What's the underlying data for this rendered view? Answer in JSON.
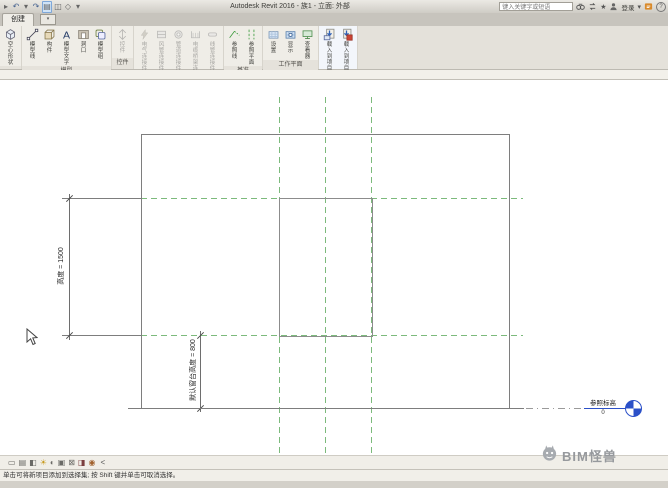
{
  "window": {
    "title": "Autodesk Revit 2016 - 族1 - 立面: 外部"
  },
  "qat": {
    "icons": [
      {
        "name": "modify-arrow-icon",
        "glyph": "▸",
        "gray": true
      },
      {
        "name": "undo-icon",
        "glyph": "↶"
      },
      {
        "name": "undo-dropdown-icon",
        "glyph": "▾",
        "gray": true
      },
      {
        "name": "redo-icon",
        "glyph": "↷"
      },
      {
        "name": "thin-lines-icon",
        "glyph": "▤",
        "highlight": true,
        "gray": true
      },
      {
        "name": "section-icon",
        "glyph": "◫",
        "gray": true
      },
      {
        "name": "default-3d-view-icon",
        "glyph": "◇",
        "gray": true
      },
      {
        "name": "qat-customize-icon",
        "glyph": "▾",
        "gray": true
      }
    ]
  },
  "titlebar": {
    "search_value": "键入关键字或短语",
    "signin_label": "登录",
    "help_glyph": "?",
    "icons": [
      "search-binoculars-icon",
      "exchange-icon",
      "favorites-star-icon",
      "sign-in-user-icon",
      "dropdown-caret-icon",
      "communication-center-icon",
      "help-icon"
    ]
  },
  "tabs": {
    "active": "创建"
  },
  "ribbon": {
    "panels": [
      {
        "label": "",
        "buttons": [
          {
            "label": "空心 形状",
            "icon": "hollow-form-icon"
          }
        ]
      },
      {
        "label": "模型",
        "buttons": [
          {
            "label": "模型 线",
            "icon": "model-line-icon"
          },
          {
            "label": "构件",
            "icon": "component-icon"
          },
          {
            "label": "模型 文字",
            "icon": "model-text-icon"
          },
          {
            "label": "洞口",
            "icon": "opening-icon"
          },
          {
            "label": "模型 组",
            "icon": "model-group-icon"
          }
        ]
      },
      {
        "label": "控件",
        "buttons": [
          {
            "label": "控件",
            "icon": "control-icon",
            "disabled": true
          }
        ]
      },
      {
        "label": "连接件",
        "buttons": [
          {
            "label": "电气 连接件",
            "icon": "electrical-connector-icon",
            "disabled": true
          },
          {
            "label": "风管 连接件",
            "icon": "duct-connector-icon",
            "disabled": true
          },
          {
            "label": "管道 连接件",
            "icon": "pipe-connector-icon",
            "disabled": true
          },
          {
            "label": "电缆桥架 连接件",
            "icon": "cable-tray-connector-icon",
            "disabled": true
          },
          {
            "label": "线管 连接件",
            "icon": "conduit-connector-icon",
            "disabled": true
          }
        ]
      },
      {
        "label": "基准",
        "buttons": [
          {
            "label": "参照 线",
            "icon": "reference-line-icon"
          },
          {
            "label": "参照 平面",
            "icon": "reference-plane-icon"
          }
        ]
      },
      {
        "label": "工作平面",
        "buttons": [
          {
            "label": "设置",
            "icon": "set-workplane-icon"
          },
          {
            "label": "显示",
            "icon": "show-workplane-icon"
          },
          {
            "label": "查看器",
            "icon": "viewer-icon"
          }
        ]
      },
      {
        "label": "族编辑器",
        "highlight": true,
        "buttons": [
          {
            "label": "载入到 项目",
            "icon": "load-into-project-icon"
          },
          {
            "label": "载入到 项目并关闭",
            "icon": "load-into-project-close-icon"
          }
        ]
      }
    ]
  },
  "canvas": {
    "dim_height": {
      "label": "高度 = 1500"
    },
    "dim_sill": {
      "label": "默认窗台高度 = 800"
    },
    "level": {
      "name": "参照标高",
      "elevation": "0"
    },
    "colors": {
      "reference_plane_green": "#7cba7c",
      "line_gray": "#7d7d7d",
      "level_blue": "#2b50c8"
    }
  },
  "view_bar": {
    "collapse_glyph": "<",
    "icons": [
      {
        "name": "view-scale-icon",
        "glyph": "▭"
      },
      {
        "name": "detail-level-icon",
        "glyph": "▤"
      },
      {
        "name": "visual-style-icon",
        "glyph": "◧"
      },
      {
        "name": "sun-path-icon",
        "glyph": "☀",
        "color": "#c89a1e"
      },
      {
        "name": "shadows-icon",
        "glyph": "◐"
      },
      {
        "name": "crop-view-icon",
        "glyph": "▣"
      },
      {
        "name": "show-crop-icon",
        "glyph": "⊠"
      },
      {
        "name": "temporary-hide-icon",
        "glyph": "◨",
        "color": "#7b3f3f"
      },
      {
        "name": "reveal-hidden-icon",
        "glyph": "◉",
        "color": "#a1622f"
      }
    ]
  },
  "status_bar": {
    "message": "单击可将新项目添加到选择集; 按 Shift 键并单击可取消选择。"
  },
  "watermark": {
    "text": "BIM怪兽"
  }
}
